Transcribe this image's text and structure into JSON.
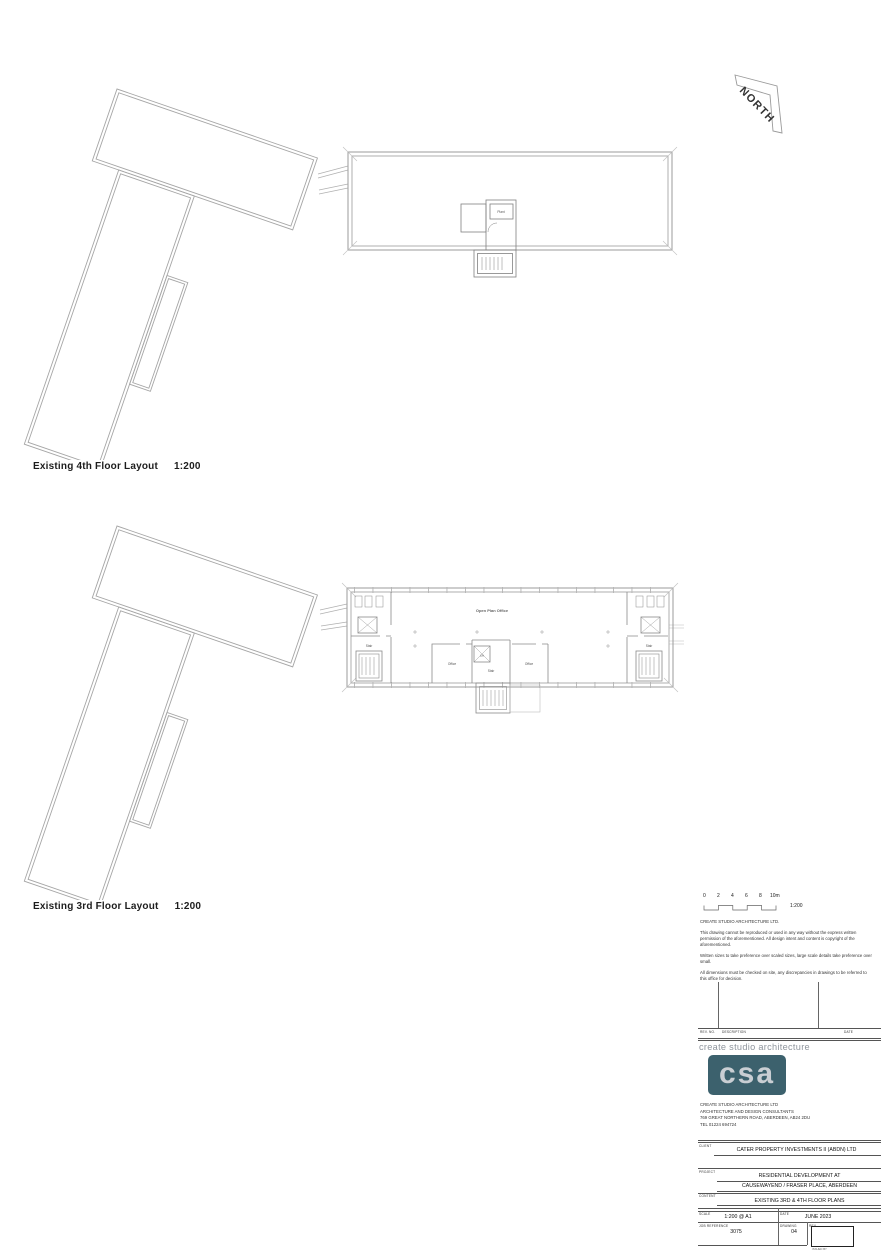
{
  "north": {
    "label": "NORTH"
  },
  "plans": {
    "upper": {
      "title": "Existing 4th Floor Layout",
      "scale": "1:200",
      "rooms": {
        "plant": "Plant"
      }
    },
    "lower": {
      "title": "Existing 3rd Floor Layout",
      "scale": "1:200",
      "rooms": {
        "open_plan": "Open Plan Office",
        "office_left": "Office",
        "office_right": "Office",
        "lift": "Lift",
        "stair_left": "Stair",
        "stair_center": "Stair",
        "stair_right": "Stair"
      }
    }
  },
  "scalebar": {
    "ticks": [
      "0",
      "2",
      "4",
      "6",
      "8",
      "10m"
    ],
    "ratio": "1:200"
  },
  "notes": {
    "heading": "CREATE STUDIO ARCHITECTURE LTD.",
    "para1": "This drawing cannot be reproduced or used in any way without the express written permission of the aforementioned. All design intent and content is copyright of the aforementioned.",
    "para2": "Written sizes to take preference over scaled sizes, large scale details take preference over small.",
    "para3": "All dimensions must be checked on site, any discrepancies in drawings to be referred to this office for decision."
  },
  "revisions": {
    "rev_no": "REV. NO.",
    "description": "DESCRIPTION",
    "date": "DATE"
  },
  "brand": {
    "wordmark": "create studio architecture",
    "monogram": "csa",
    "logo_bg": "#3c616d",
    "logo_fg": "#c9ced3",
    "company": "CREATE STUDIO ARCHITECTURE LTD",
    "tagline": "ARCHITECTURE AND DESIGN CONSULTANTS",
    "address": "769 GREAT NORTHERN ROAD,   ABERDEEN,   AB24 2DU",
    "tel": "TEL 01224 694724"
  },
  "titleblock": {
    "client_label": "CLIENT",
    "client": "CATER PROPERTY INVESTMENTS II (ABDN) LTD",
    "project_label": "PROJECT",
    "project_line1": "RESIDENTIAL DEVELOPMENT AT",
    "project_line2": "CAUSEWAYEND / FRASER PLACE, ABERDEEN",
    "content_label": "CONTENT",
    "content": "EXISTING 3RD & 4TH FLOOR PLANS",
    "scale_label": "SCALE",
    "scale": "1:200 @ A1",
    "date_label": "DATE",
    "date": "JUNE 2023",
    "job_label": "JOB REFERENCE",
    "job": "3075",
    "drawing_label": "DRAWING",
    "drawing": "04",
    "rev_label": "REV.",
    "issued_note": "ISSUED BY"
  }
}
